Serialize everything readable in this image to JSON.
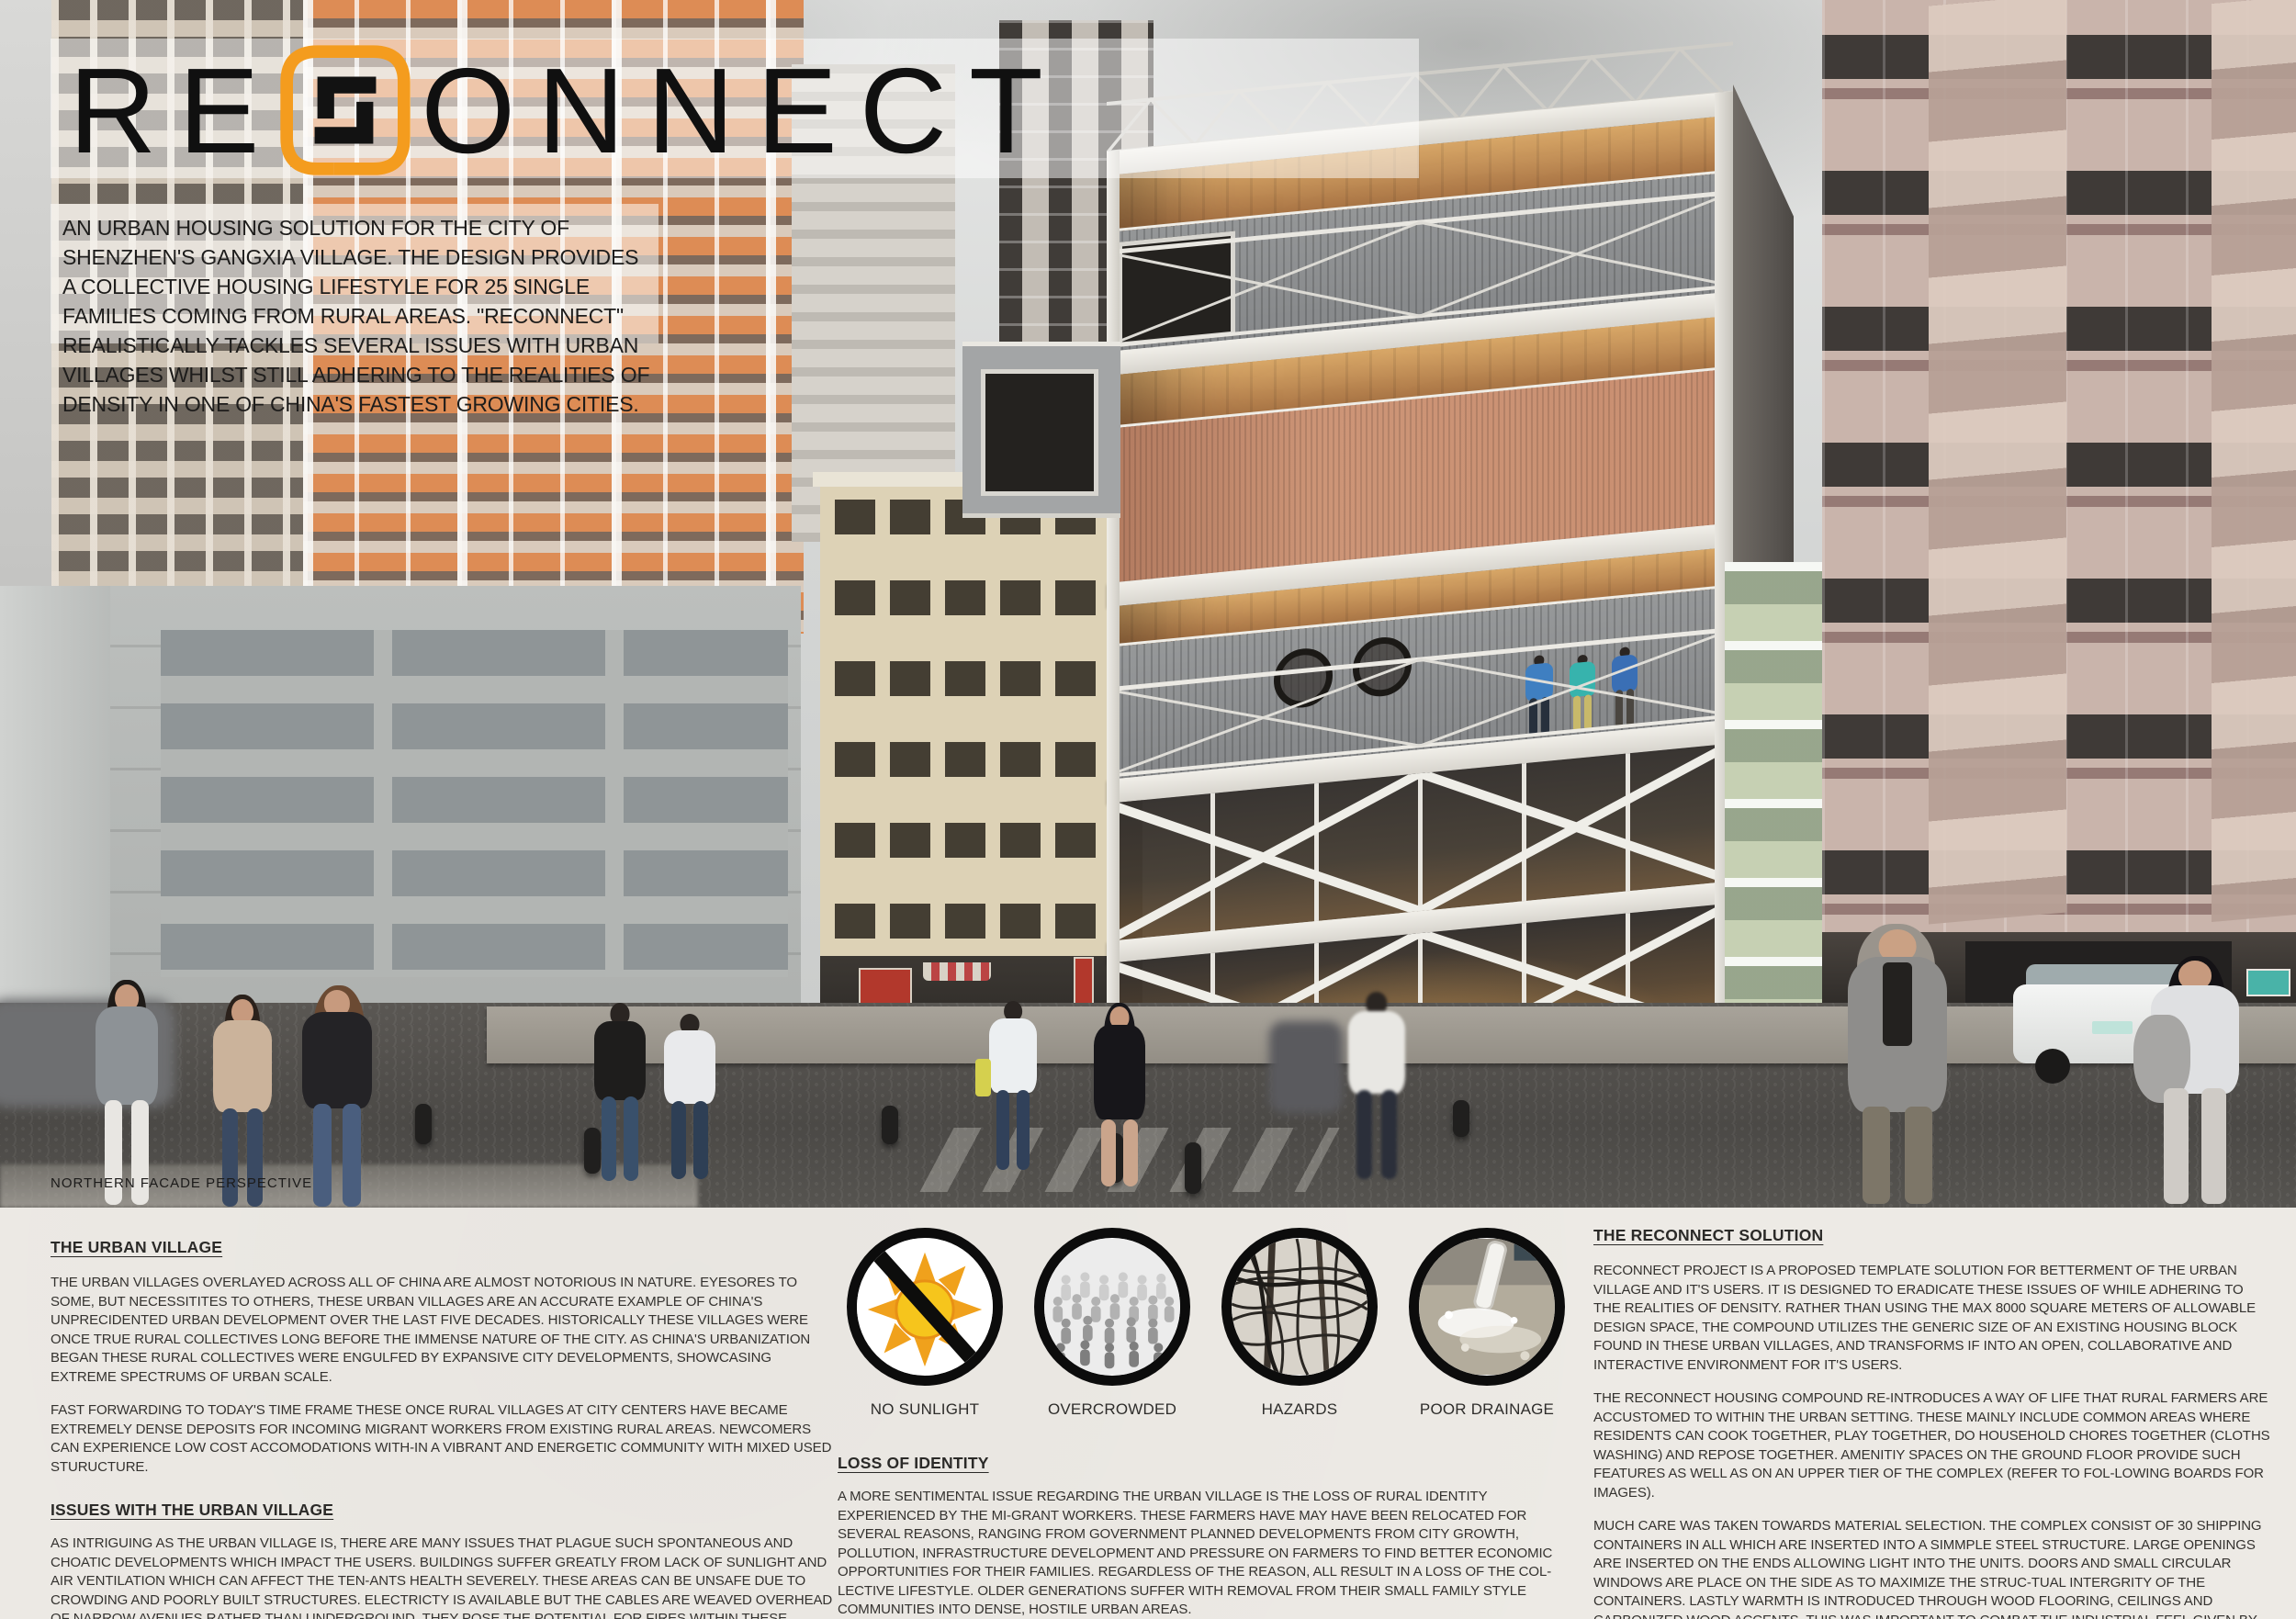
{
  "board": {
    "title_prefix": "RE",
    "title_suffix": "ONNECT"
  },
  "intro": "AN URBAN HOUSING SOLUTION FOR THE CITY OF SHENZHEN'S GANGXIA VILLAGE. THE DESIGN PROVIDES A COLLECTIVE HOUSING LIFESTYLE FOR 25 SINGLE FAMILIES COMING FROM RURAL AREAS. \"RECONNECT\" REALISTICALLY TACKLES SEVERAL ISSUES WITH URBAN VILLAGES WHILST STILL ADHERING TO THE REALITIES OF DENSITY IN ONE OF CHINA'S FASTEST GROWING CITIES.",
  "render_caption": "NORTHERN FACADE PERSPECTIVE",
  "left_column": {
    "heading1": "THE URBAN VILLAGE",
    "urban_p1": "THE URBAN VILLAGES OVERLAYED ACROSS ALL OF CHINA ARE ALMOST NOTORIOUS IN NATURE. EYESORES TO SOME, BUT NECESSITITES TO OTHERS, THESE URBAN VILLAGES ARE AN ACCURATE EXAMPLE OF CHINA'S UNPRECIDENTED URBAN DEVELOPMENT OVER THE LAST FIVE DECADES.  HISTORICALLY THESE VILLAGES WERE ONCE TRUE RURAL COLLECTIVES LONG BEFORE THE IMMENSE NATURE OF THE CITY.  AS CHINA'S URBANIZATION BEGAN THESE RURAL COLLECTIVES WERE ENGULFED BY EXPANSIVE CITY DEVELOPMENTS, SHOWCASING EXTREME SPECTRUMS OF URBAN SCALE.",
    "urban_p2": "FAST FORWARDING TO TODAY'S TIME FRAME THESE ONCE RURAL VILLAGES AT CITY CENTERS HAVE BECAME EXTREMELY DENSE DEPOSITS FOR INCOMING MIGRANT WORKERS FROM EXISTING RURAL AREAS. NEWCOMERS CAN EXPERIENCE LOW COST ACCOMODATIONS WITH-IN A VIBRANT AND ENERGETIC COMMUNITY WITH MIXED USED STURUCTURE.",
    "heading2": "ISSUES WITH THE URBAN VILLAGE",
    "issues_p1": "AS INTRIGUING AS THE URBAN VILLAGE IS, THERE ARE MANY ISSUES THAT PLAGUE SUCH SPONTANEOUS AND CHOATIC DEVELOPMENTS WHICH IMPACT THE USERS. BUILDINGS SUFFER GREATLY FROM LACK OF SUNLIGHT AND AIR VENTILATION  WHICH CAN AFFECT THE TEN-ANTS HEALTH SEVERELY.  THESE AREAS CAN BE UNSAFE DUE TO CROWDING AND POORLY BUILT STRUCTURES. ELECTRICTY IS AVAILABLE BUT THE CABLES ARE WEAVED OVERHEAD OF NARROW AVENUES RATHER THAN UNDERGROUND. THEY POSE THE POTENTIAL FOR FIRES WITHIN THESE SPACES. FURTHERMORE THE SEVERE LACK OF PUBLIC SPACES FOR PEOPLE TO COMMUNE TO MAKE FOR UNEVENTFUL DAILY RITUALS AND ROADS CAN BECOME WATERLOGGED FROM RAINWATER AND SEWAGE."
  },
  "middle_column": {
    "icons": [
      {
        "name": "no-sunlight-icon",
        "label": "NO SUNLIGHT"
      },
      {
        "name": "overcrowded-icon",
        "label": "OVERCROWDED"
      },
      {
        "name": "hazards-icon",
        "label": "HAZARDS"
      },
      {
        "name": "poor-drainage-icon",
        "label": "POOR DRAINAGE"
      }
    ],
    "heading": "LOSS OF IDENTITY",
    "loss_p1": "A MORE SENTIMENTAL ISSUE REGARDING THE URBAN VILLAGE IS THE LOSS OF RURAL IDENTITY EXPERIENCED BY THE MI-GRANT WORKERS.  THESE FARMERS HAVE MAY HAVE BEEN RELOCATED FOR SEVERAL REASONS, RANGING FROM GOVERNMENT PLANNED DEVELOPMENTS FROM CITY GROWTH, POLLUTION, INFRASTRUCTURE DEVELOPMENT AND PRESSURE ON FARMERS TO FIND BETTER ECONOMIC OPPORTUNITIES FOR THEIR FAMILIES. REGARDLESS OF THE REASON, ALL RESULT IN A LOSS OF THE COL-LECTIVE LIFESTYLE.  OLDER GENERATIONS SUFFER WITH REMOVAL FROM THEIR SMALL FAMILY STYLE COMMUNITIES INTO DENSE, HOSTILE URBAN AREAS."
  },
  "right_column": {
    "heading": "THE RECONNECT SOLUTION",
    "p1": "RECONNECT PROJECT IS A PROPOSED TEMPLATE SOLUTION FOR BETTERMENT OF THE URBAN VILLAGE AND IT'S USERS. IT IS DESIGNED TO ERADICATE THESE ISSUES OF WHILE ADHERING TO THE REALITIES OF DENSITY.  RATHER THAN USING THE MAX 8000 SQUARE METERS OF ALLOWABLE DESIGN SPACE, THE COMPOUND UTILIZES THE GENERIC SIZE OF AN EXISTING HOUSING BLOCK FOUND IN THESE URBAN VILLAGES, AND TRANSFORMS IF INTO AN OPEN, COLLABORATIVE AND INTERACTIVE ENVIRONMENT FOR IT'S USERS.",
    "p2": "THE RECONNECT HOUSING COMPOUND  RE-INTRODUCES A WAY OF LIFE THAT RURAL FARMERS ARE ACCUSTOMED TO WITHIN THE URBAN SETTING. THESE MAINLY INCLUDE COMMON AREAS WHERE RESIDENTS CAN COOK TOGETHER, PLAY TOGETHER, DO HOUSEHOLD CHORES TOGETHER (CLOTHS WASHING) AND REPOSE TOGETHER. AMENITIY SPACES ON THE GROUND FLOOR PROVIDE SUCH FEATURES AS WELL AS ON AN UPPER TIER OF THE COMPLEX (REFER TO FOL-LOWING BOARDS FOR IMAGES).",
    "p3": "MUCH CARE WAS TAKEN TOWARDS MATERIAL SELECTION. THE COMPLEX CONSIST OF 30 SHIPPING CONTAINERS IN ALL WHICH ARE INSERTED INTO A SIMMPLE STEEL STRUCTURE. LARGE OPENINGS ARE INSERTED ON THE ENDS ALLOWING LIGHT INTO THE UNITS. DOORS AND SMALL CIRCULAR WINDOWS ARE PLACE ON THE SIDE AS TO MAXIMIZE THE STRUC-TUAL INTERGRITY OF THE CONTAINERS. LASTLY WARMTH IS INTRODUCED THROUGH WOOD FLOORING, CEILINGS AND CARBONIZED WOOD ACCENTS.  THIS WAS IMPORTANT TO COMBAT THE INDUSTRIAL FEEL GIVEN BY THE OCNTAINERS. THIS TECHNIQUE PAIRED WITH COLOR SELECTIONS FOR THE OCNTAINER MAKE FOR  AAN AESTHEITCALLY PLEASING ARCHITECTURE."
  },
  "colors": {
    "accent_orange": "#F49C1E",
    "paper": "#EDEAE5",
    "ink": "#2F2D2B"
  }
}
